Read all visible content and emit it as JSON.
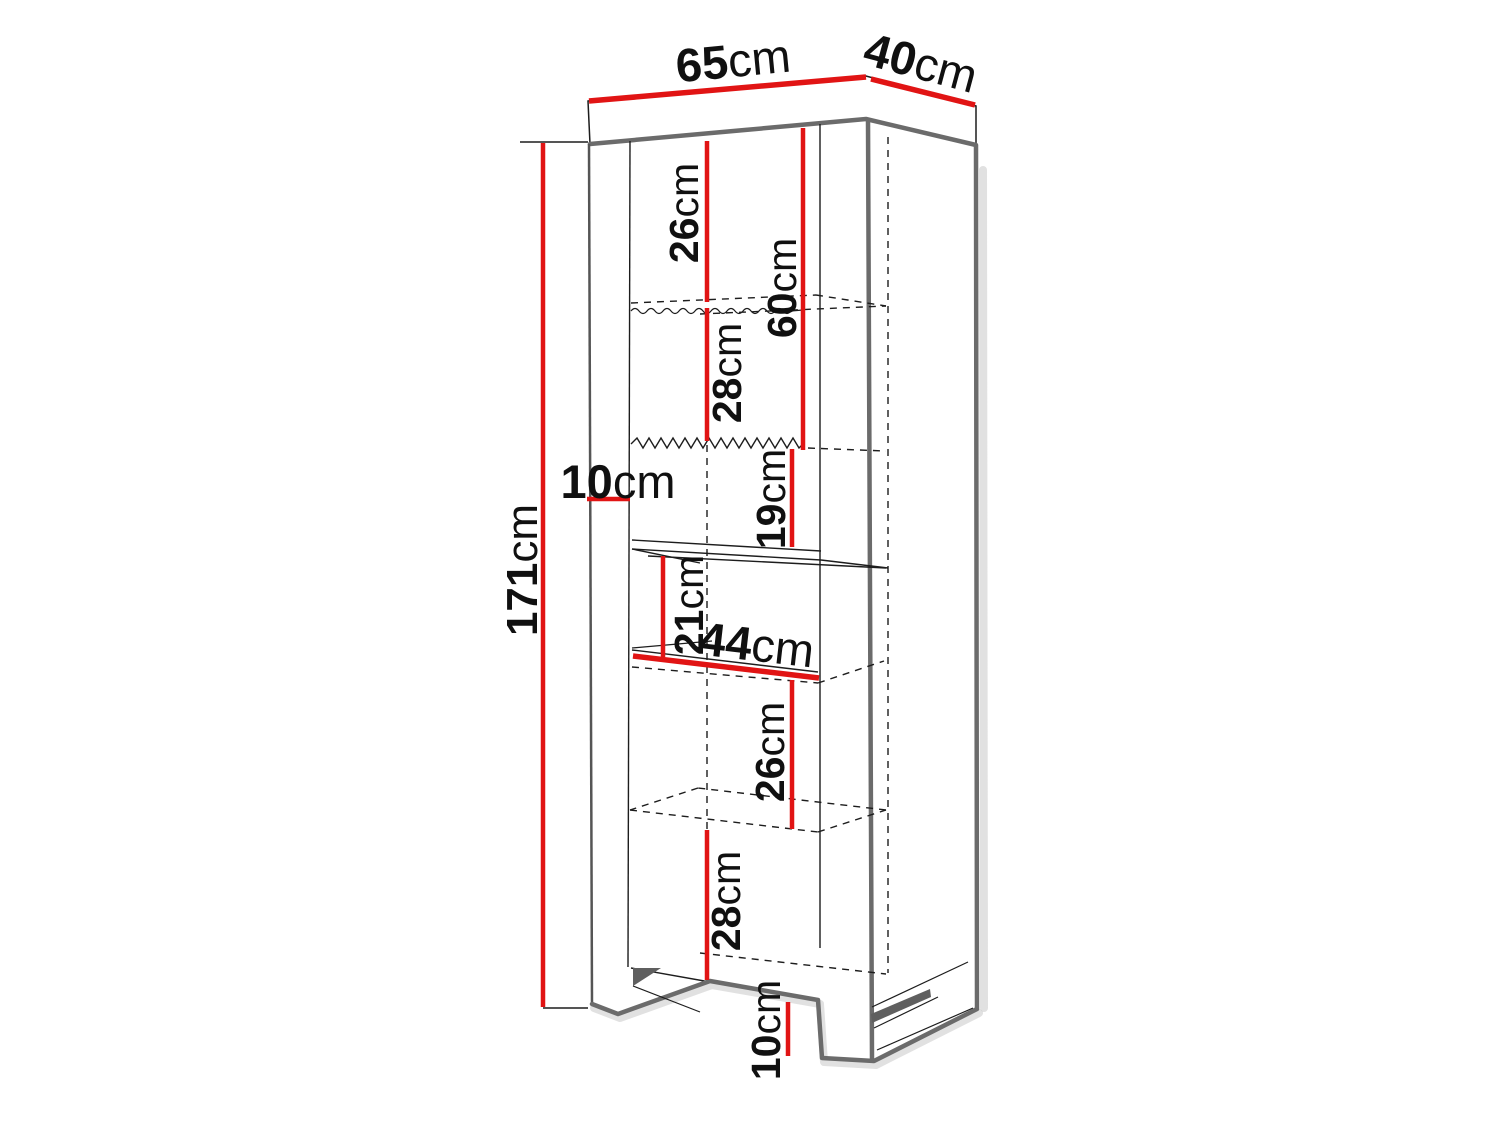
{
  "diagram": {
    "description": "Dimension drawing of a tall shelving cabinet in oblique perspective",
    "unit": "cm",
    "accent_color": "#e11414",
    "outline_color": "#6b6b6b",
    "dims": {
      "d65": {
        "value": "65",
        "unit": "cm",
        "meaning": "overall width (top panel front edge)"
      },
      "d40": {
        "value": "40",
        "unit": "cm",
        "meaning": "overall depth (top panel side edge)"
      },
      "d171": {
        "value": "171",
        "unit": "cm",
        "meaning": "overall height"
      },
      "d26top": {
        "value": "26",
        "unit": "cm",
        "meaning": "gap top to first shelf"
      },
      "d60": {
        "value": "60",
        "unit": "cm",
        "meaning": "upper section height"
      },
      "d28top": {
        "value": "28",
        "unit": "cm",
        "meaning": "gap first shelf to second shelf"
      },
      "d10side": {
        "value": "10",
        "unit": "cm",
        "meaning": "side panel width"
      },
      "d19": {
        "value": "19",
        "unit": "cm",
        "meaning": "gap second shelf to fixed shelf"
      },
      "d21": {
        "value": "21",
        "unit": "cm",
        "meaning": "gap fixed shelf to next shelf"
      },
      "d44": {
        "value": "44",
        "unit": "cm",
        "meaning": "interior width"
      },
      "d26bottom": {
        "value": "26",
        "unit": "cm",
        "meaning": "gap shelf to lower shelf"
      },
      "d28bottom": {
        "value": "28",
        "unit": "cm",
        "meaning": "gap lower shelf to cabinet floor"
      },
      "d10bottom": {
        "value": "10",
        "unit": "cm",
        "meaning": "plinth height"
      }
    }
  }
}
